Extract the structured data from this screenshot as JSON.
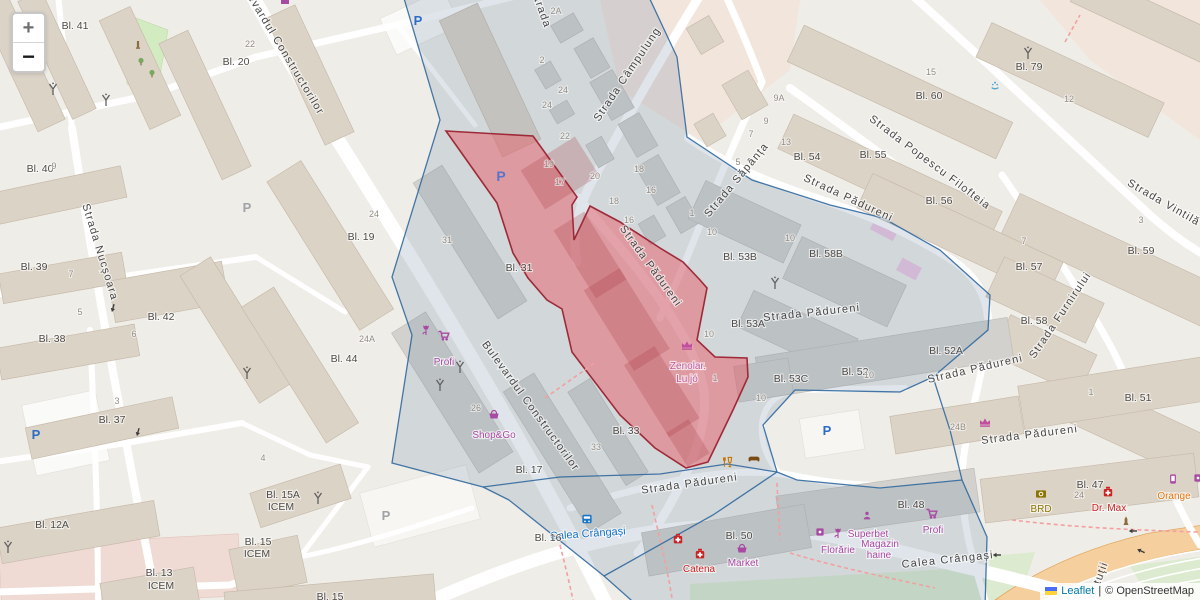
{
  "controls": {
    "zoom_in": "+",
    "zoom_out": "−"
  },
  "attribution": {
    "leaflet": "Leaflet",
    "separator": "|",
    "copyright": "© OpenStreetMap"
  },
  "icons": {
    "parking_label": "P"
  },
  "colors": {
    "selected_area_fill": "#e75d68",
    "selected_area_border": "#9e2a38",
    "district_border": "#31699e",
    "poi_purple": "#a849a3",
    "poi_red": "#cc2222",
    "poi_orange": "#e8770d",
    "poi_bank": "#8a7500",
    "transit_blue": "#1673c8",
    "link_blue": "#0078a8"
  },
  "streets": {
    "constructorilor": [
      "Bulevardul Constructorilor",
      "Bulevardul Constructorilor"
    ],
    "campulung": "Strada Câmpulung",
    "sapanta": "Strada Săpânța",
    "padureni": [
      "Strada Pădureni",
      "Strada Pădureni",
      "Strada Pădureni",
      "Strada Pădureni",
      "Strada Pădureni",
      "Strada Pădureni"
    ],
    "nucsoara": "Strada Nucșoara",
    "popescu_filofteia": "Strada Popescu Filofteia",
    "vintila_partial": "Strada Vintilă Mi",
    "furnirului": "Strada Furnirului",
    "crangasi": [
      "Calea Crângași",
      "Calea Crângași"
    ],
    "top_partial": "Strada",
    "bottom_right_partial": "tuții"
  },
  "blocks": {
    "bl41": "Bl. 41",
    "bl20": "Bl. 20",
    "bl40": "Bl. 40",
    "bl39": "Bl. 39",
    "bl38": "Bl. 38",
    "bl42": "Bl. 42",
    "bl37": "Bl. 37",
    "bl12a": "Bl. 12A",
    "bl15a": {
      "l1": "Bl. 15A",
      "l2": "ICEM"
    },
    "bl15": {
      "l1": "Bl. 15",
      "l2": "ICEM"
    },
    "bl13": {
      "l1": "Bl. 13",
      "l2": "ICEM"
    },
    "bl15b": "Bl. 15",
    "bl19": "Bl. 19",
    "bl44": "Bl. 44",
    "bl31": "Bl. 31",
    "bl17": "Bl. 17",
    "bl33": "Bl. 33",
    "bl16": "Bl. 16",
    "bl53b": "Bl. 53B",
    "bl58b": "Bl. 58B",
    "bl53a": "Bl. 53A",
    "bl53c": "Bl. 53C",
    "bl52": "Bl. 52",
    "bl52a": "Bl. 52A",
    "bl54": "Bl. 54",
    "bl55": "Bl. 55",
    "bl56": "Bl. 56",
    "bl60": "Bl. 60",
    "bl79": "Bl. 79",
    "bl59": "Bl. 59",
    "bl57": "Bl. 57",
    "bl58": "Bl. 58",
    "bl51": "Bl. 51",
    "bl47": "Bl. 47",
    "bl48": "Bl. 48",
    "bl50": "Bl. 50"
  },
  "housenumbers": [
    "9",
    "7",
    "5",
    "6",
    "3",
    "4",
    "22",
    "24",
    "24A",
    "2A",
    "2",
    "24",
    "24",
    "22",
    "20",
    "19",
    "17",
    "18",
    "16",
    "18",
    "16",
    "1",
    "10",
    "9A",
    "9",
    "7",
    "5",
    "13",
    "15",
    "12",
    "3",
    "7",
    "1",
    "10",
    "10",
    "10",
    "10",
    "1",
    "26",
    "31",
    "33",
    "24B",
    "24"
  ],
  "pois": {
    "profi_nw": "Profi",
    "shop_go": "Shop&Go",
    "zenolar": {
      "l1": "Zenolar.",
      "l2": "Lu jó"
    },
    "catena": "Catena",
    "market": "Market",
    "superbet": "Superbet",
    "magazin_haine": {
      "l1": "Magazin",
      "l2": "haine"
    },
    "florarie": "Florărie",
    "profi_se": "Profi",
    "brd": "BRD",
    "dr_max": "Dr. Max",
    "orange": "Orange"
  }
}
